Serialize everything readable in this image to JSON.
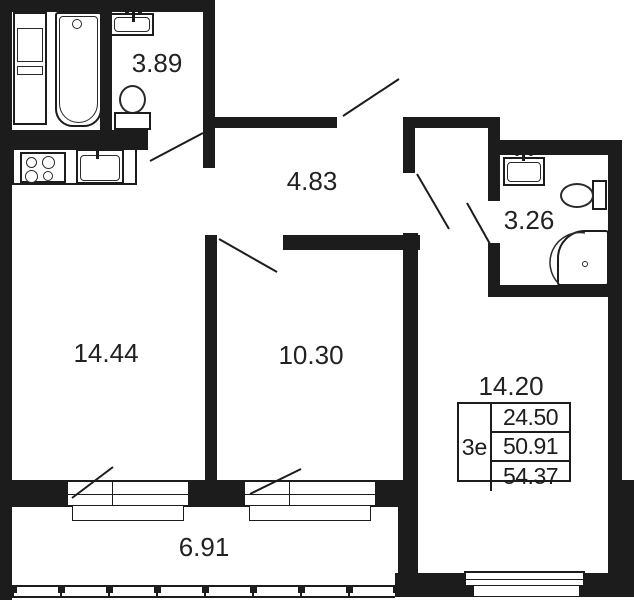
{
  "title": "Apartment floor plan",
  "rooms": {
    "bathroom_top": {
      "area": "3.89"
    },
    "kitchen_living": {
      "area": "14.44"
    },
    "hallway": {
      "area": "4.83"
    },
    "bedroom": {
      "area": "10.30"
    },
    "bathroom_right": {
      "area": "3.26"
    },
    "living_room": {
      "area": "14.20"
    },
    "balcony": {
      "area": "6.91"
    }
  },
  "info_table": {
    "type_label": "3е",
    "rows": [
      "24.50",
      "50.91",
      "54.37"
    ]
  },
  "colors": {
    "wall": "#1c1c1c",
    "background": "#ffffff"
  }
}
